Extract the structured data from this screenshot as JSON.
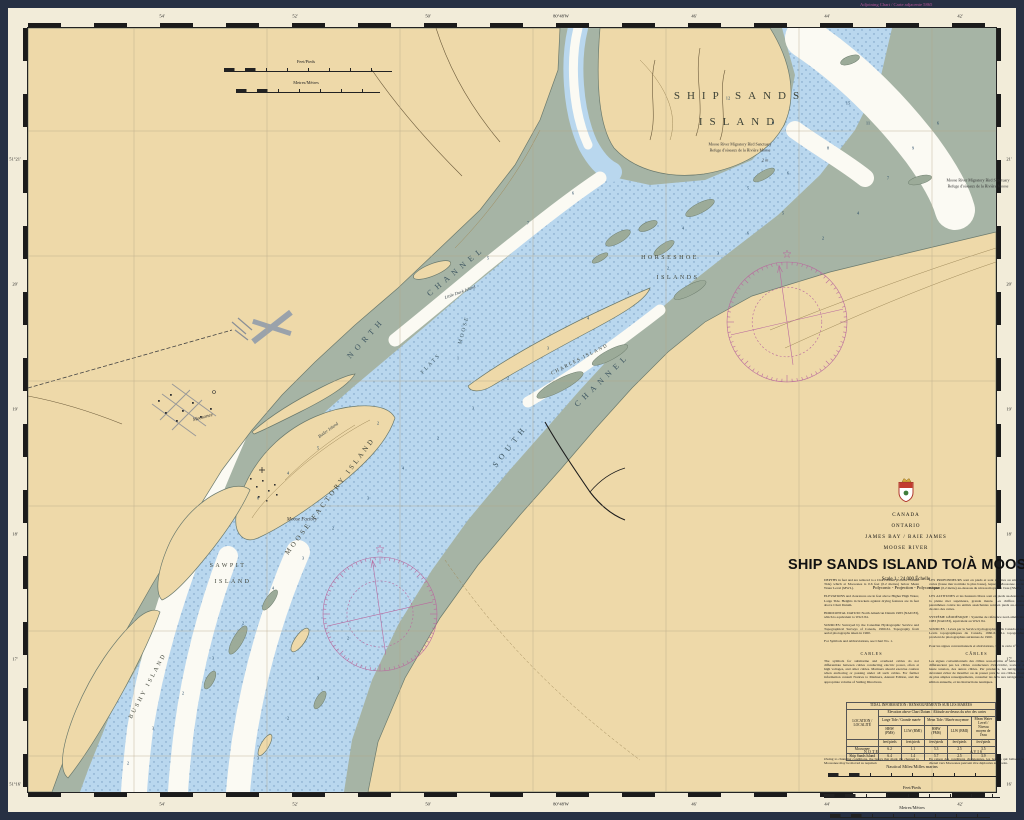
{
  "frame": {
    "adjoining_chart": "Adjoining Chart / Carte adjacente 5865"
  },
  "colors": {
    "land_tan": "#eed9a9",
    "flats_green": "#a6b4a5",
    "shallow_blue": "#b9d7ee",
    "deep_white": "#fbfaf3",
    "magenta": "#b9559b",
    "frame_dark": "#273043"
  },
  "title_block": {
    "country": "CANADA",
    "province": "ONTARIO",
    "region": "JAMES BAY / BAIE JAMES",
    "river": "MOOSE RIVER",
    "title": "SHIP SANDS ISLAND TO/À MOOSONEE",
    "scale": "Scale 1 : 24 000 Échelle",
    "projection": "Polyconic - Projection - Polyconique",
    "crest_icon": "canada-crest-icon",
    "notes_en": [
      "DEPTHS in feet and are reduced to a Chart Datum (Lowest Normal Tide) which at Moosonee is 0.6 feet (0.2 metres) below Mean Water Level (MWL).",
      "ELEVATIONS and clearances are in feet above Higher High Water, Large Tide. Heights in brackets against drying features are in feet above Chart Datum.",
      "HORIZONTAL DATUM: North American Datum 1983 (NAD 83), which is equivalent to WGS 84.",
      "SOURCES: Surveyed by the Canadian Hydrographic Service and Topographical Surveys of Canada, 1960-61. Topography from aerial photographs taken in 1960.",
      "For Symbols and Abbreviations, see Chart No. 1."
    ],
    "notes_fr": [
      "LES PROFONDEURS sont en pieds et sont réduites au zéro des cartes (basse mer normale la plus basse), lequel à Moosonee est de 0,6 pied (0,2 mètre) au-dessous du niveau moyen de l'eau (NME).",
      "LES ALTITUDES et les hauteurs libres sont en pieds au-dessus de la pleine mer supérieure, grande marée. Les chiffres entre parenthèses contre les entités asséchantes sont en pieds au-dessus du zéro des cartes.",
      "SYSTÈME GÉODÉSIQUE : Système de référence nord-américain 1983 (NAD 83), équivalent au WGS 84.",
      "SOURCES : Levés par le Service hydrographique du Canada et les Levés topographiques du Canada, 1960-61. La topographie provient de photographies aériennes de 1960.",
      "Pour les signes conventionnels et abréviations, voir la carte n° 1."
    ],
    "cables_heading_en": "CABLES",
    "cables_en": "The symbols for submarine and overhead cables do not differentiate between cables conducting electric power, often at high voltages, and other cables. Mariners should exercise caution when anchoring or passing under all such cables. For further information consult Notices to Mariners, Annual Edition, and the appropriate volume of Sailing Directions.",
    "cables_heading_fr": "CÂBLES",
    "cables_fr": "Les signes conventionnels des câbles sous-marins et aériens ne différencient pas les câbles conducteurs d'électricité, souvent à haute tension, des autres câbles. Par prudence, les navigateurs devraient éviter de mouiller ou de passer près de ces câbles. Pour de plus amples renseignements, consulter les Avis aux navigateurs, édition annuelle, et les Instructions nautiques.",
    "note_heading_en": "NOTE",
    "note_en": "Owing to changing conditions, the buoys that mark the channel to Moosonee may be moved as required.",
    "note_heading_fr": "AVIS",
    "note_fr": "En raison des conditions changeantes, les bouées qui balisent le chenal vers Moosonee peuvent être déplacées au besoin."
  },
  "tide_table": {
    "title": "TIDAL INFORMATION / RENSEIGNEMENTS SUR LES MARÉES",
    "location_header": "LOCATION / LOCALITÉ",
    "elevation_header": "Elevation above Chart Datum / Altitude au-dessus du zéro des cartes",
    "group_headers": [
      "Large Tide / Grande marée",
      "Mean Tide / Marée moyenne",
      "Mean Water Level / Niveau moyen de l'eau"
    ],
    "sub_headers": [
      "HHW (PMS)",
      "LLW (BMI)",
      "HHW (PMS)",
      "LLW (BMI)"
    ],
    "units_row": [
      "feet/pieds",
      "feet/pieds",
      "feet/pieds",
      "feet/pieds",
      "feet/pieds"
    ],
    "rows": [
      {
        "location": "Moosonee",
        "values": [
          "6.2",
          "1.1",
          "5.3",
          "2.5",
          "3.5"
        ]
      },
      {
        "location": "Ship Sands Island",
        "values": [
          "6.4",
          "1.4",
          "5.7",
          "2.5",
          "3.9"
        ]
      }
    ]
  },
  "scale_bars": {
    "top": [
      {
        "label": "Feet/Pieds"
      },
      {
        "label": "Metres/Mètres"
      }
    ],
    "bottom": [
      {
        "label": "Nautical Miles/Milles marins"
      },
      {
        "label": "Feet/Pieds"
      },
      {
        "label": "Metres/Mètres"
      }
    ]
  },
  "map_labels": [
    {
      "t": "SHIP SANDS",
      "x": 712,
      "y": 68,
      "r": 0,
      "c": "big"
    },
    {
      "t": "ISLAND",
      "x": 712,
      "y": 94,
      "r": 0,
      "c": "big"
    },
    {
      "t": "Moose River Migratory Bird Sanctuary",
      "x": 712,
      "y": 116,
      "r": 0,
      "c": "tiny"
    },
    {
      "t": "Refuge d'oiseaux de la Rivière Moose",
      "x": 712,
      "y": 122,
      "r": 0,
      "c": "tiny"
    },
    {
      "t": "2 m",
      "x": 737,
      "y": 132,
      "r": 0,
      "c": "tiny-i"
    },
    {
      "t": "Moose River Migratory Bird Sanctuary",
      "x": 950,
      "y": 152,
      "r": 0,
      "c": "tiny"
    },
    {
      "t": "Refuge d'oiseaux de la Rivière Moose",
      "x": 950,
      "y": 158,
      "r": 0,
      "c": "tiny"
    },
    {
      "t": "NORTH",
      "x": 338,
      "y": 310,
      "r": -48,
      "c": "chan"
    },
    {
      "t": "CHANNEL",
      "x": 428,
      "y": 243,
      "r": -40,
      "c": "chan"
    },
    {
      "t": "SOUTH",
      "x": 482,
      "y": 418,
      "r": -52,
      "c": "chan"
    },
    {
      "t": "CHANNEL",
      "x": 574,
      "y": 352,
      "r": -44,
      "c": "chan"
    },
    {
      "t": "HORSESHOE",
      "x": 642,
      "y": 230,
      "r": 0,
      "c": "isl"
    },
    {
      "t": "ISLANDS",
      "x": 650,
      "y": 250,
      "r": 0,
      "c": "isl"
    },
    {
      "t": "MOOSE FACTORY ISLAND",
      "x": 302,
      "y": 468,
      "r": -53,
      "c": "isl2"
    },
    {
      "t": "SAWPIT",
      "x": 200,
      "y": 538,
      "r": 0,
      "c": "isl"
    },
    {
      "t": "ISLAND",
      "x": 205,
      "y": 554,
      "r": 0,
      "c": "isl"
    },
    {
      "t": "BUSHY ISLAND",
      "x": 120,
      "y": 658,
      "r": -62,
      "c": "isl"
    },
    {
      "t": "CHARLES ISLAND",
      "x": 552,
      "y": 332,
      "r": -27,
      "c": "isl-s"
    },
    {
      "t": "Butler Island",
      "x": 300,
      "y": 402,
      "r": -36,
      "c": "sm"
    },
    {
      "t": "Little Duck Island",
      "x": 432,
      "y": 264,
      "r": -20,
      "c": "sm"
    },
    {
      "t": "MOOSE",
      "x": 436,
      "y": 302,
      "r": -75,
      "c": "flats"
    },
    {
      "t": "FLATS",
      "x": 403,
      "y": 336,
      "r": -46,
      "c": "flats"
    },
    {
      "t": "Moosonee",
      "x": 175,
      "y": 390,
      "r": -15,
      "c": "town"
    },
    {
      "t": "Moose Factory",
      "x": 274,
      "y": 492,
      "r": 0,
      "c": "town"
    }
  ],
  "soundings": [
    [
      700,
      70,
      "12"
    ],
    [
      745,
      95,
      "9"
    ],
    [
      820,
      75,
      "15"
    ],
    [
      860,
      150,
      "7"
    ],
    [
      885,
      120,
      "9"
    ],
    [
      910,
      95,
      "6"
    ],
    [
      840,
      95,
      "11"
    ],
    [
      800,
      120,
      "8"
    ],
    [
      760,
      145,
      "6"
    ],
    [
      720,
      160,
      "5"
    ],
    [
      655,
      200,
      "4"
    ],
    [
      690,
      225,
      "3"
    ],
    [
      720,
      205,
      "6"
    ],
    [
      755,
      185,
      "5"
    ],
    [
      795,
      210,
      "2"
    ],
    [
      830,
      185,
      "4"
    ],
    [
      640,
      240,
      "2"
    ],
    [
      600,
      265,
      "3"
    ],
    [
      560,
      290,
      "4"
    ],
    [
      520,
      320,
      "3"
    ],
    [
      480,
      350,
      "2"
    ],
    [
      445,
      380,
      "3"
    ],
    [
      410,
      410,
      "2"
    ],
    [
      375,
      440,
      "4"
    ],
    [
      340,
      470,
      "3"
    ],
    [
      305,
      500,
      "2"
    ],
    [
      275,
      530,
      "3"
    ],
    [
      245,
      560,
      "4"
    ],
    [
      215,
      595,
      "2"
    ],
    [
      185,
      630,
      "3"
    ],
    [
      155,
      665,
      "2"
    ],
    [
      125,
      700,
      "3"
    ],
    [
      100,
      735,
      "2"
    ],
    [
      460,
      230,
      "5"
    ],
    [
      500,
      195,
      "7"
    ],
    [
      545,
      165,
      "6"
    ],
    [
      430,
      330,
      "1"
    ],
    [
      350,
      395,
      "2"
    ],
    [
      230,
      470,
      "6"
    ],
    [
      260,
      445,
      "4"
    ],
    [
      290,
      420,
      "5"
    ],
    [
      320,
      610,
      "2"
    ],
    [
      290,
      650,
      "3"
    ],
    [
      260,
      690,
      "2"
    ],
    [
      230,
      730,
      "3"
    ]
  ],
  "border_labels": {
    "top": [
      {
        "x": 134,
        "t": "54'"
      },
      {
        "x": 267,
        "t": "52'"
      },
      {
        "x": 400,
        "t": "50'"
      },
      {
        "x": 533,
        "t": "80°48'W"
      },
      {
        "x": 666,
        "t": "46'"
      },
      {
        "x": 799,
        "t": "44'"
      },
      {
        "x": 932,
        "t": "42'"
      }
    ],
    "bottom": [
      {
        "x": 134,
        "t": "54'"
      },
      {
        "x": 267,
        "t": "52'"
      },
      {
        "x": 400,
        "t": "50'"
      },
      {
        "x": 533,
        "t": "80°48'W"
      },
      {
        "x": 666,
        "t": "46'"
      },
      {
        "x": 799,
        "t": "44'"
      },
      {
        "x": 932,
        "t": "42'"
      }
    ],
    "left": [
      {
        "y": 131,
        "t": "51°21'"
      },
      {
        "y": 256,
        "t": "20'"
      },
      {
        "y": 381,
        "t": "19'"
      },
      {
        "y": 506,
        "t": "18'"
      },
      {
        "y": 631,
        "t": "17'"
      },
      {
        "y": 756,
        "t": "51°16'"
      }
    ],
    "right": [
      {
        "y": 131,
        "t": "21'"
      },
      {
        "y": 256,
        "t": "20'"
      },
      {
        "y": 381,
        "t": "19'"
      },
      {
        "y": 506,
        "t": "18'"
      },
      {
        "y": 631,
        "t": "17'"
      },
      {
        "y": 756,
        "t": "16'"
      }
    ]
  },
  "compass_roses": [
    {
      "cx": 787,
      "cy": 322,
      "r": 60
    },
    {
      "cx": 380,
      "cy": 614,
      "r": 57
    }
  ]
}
